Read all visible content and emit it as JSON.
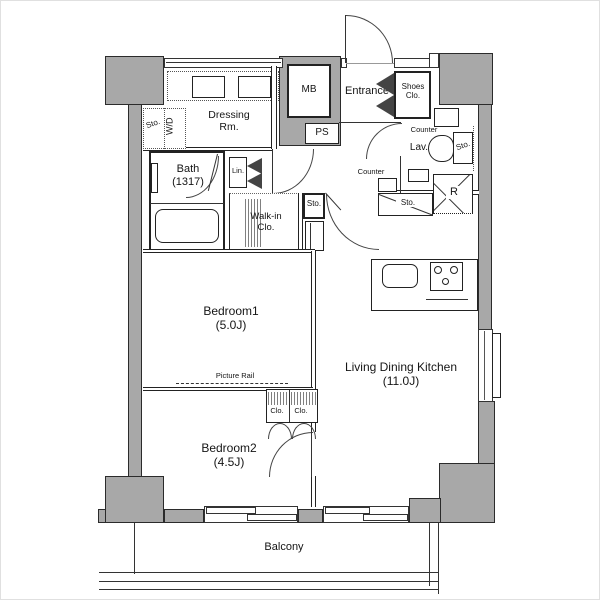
{
  "meta": {
    "type": "floor-plan",
    "description": "Japanese apartment floor plan 1LDK+"
  },
  "colors": {
    "wall": "#a8a8a8",
    "line": "#222222",
    "background": "#ffffff"
  },
  "labels": {
    "sto_wd": "Sto.",
    "wd": "W/D",
    "dressing": "Dressing\nRm.",
    "bath": "Bath\n(1317)",
    "lin": "Lin.",
    "mb": "MB",
    "ps": "PS",
    "entrance": "Entrance",
    "shoes": "Shoes\nClo.",
    "counter_lav": "Counter",
    "lav": "Lav.",
    "sto_lav": "Sto.",
    "counter_hall": "Counter",
    "sto_hall": "Sto.",
    "sto_kitchen": "Sto.",
    "fridge": "R",
    "walkin": "Walk-in\nClo.",
    "bedroom1": "Bedroom1\n(5.0J)",
    "picture_rail": "Picture Rail",
    "clo1": "Clo.",
    "clo2": "Clo.",
    "bedroom2": "Bedroom2\n(4.5J)",
    "ldk": "Living Dining Kitchen\n(11.0J)",
    "balcony": "Balcony"
  }
}
